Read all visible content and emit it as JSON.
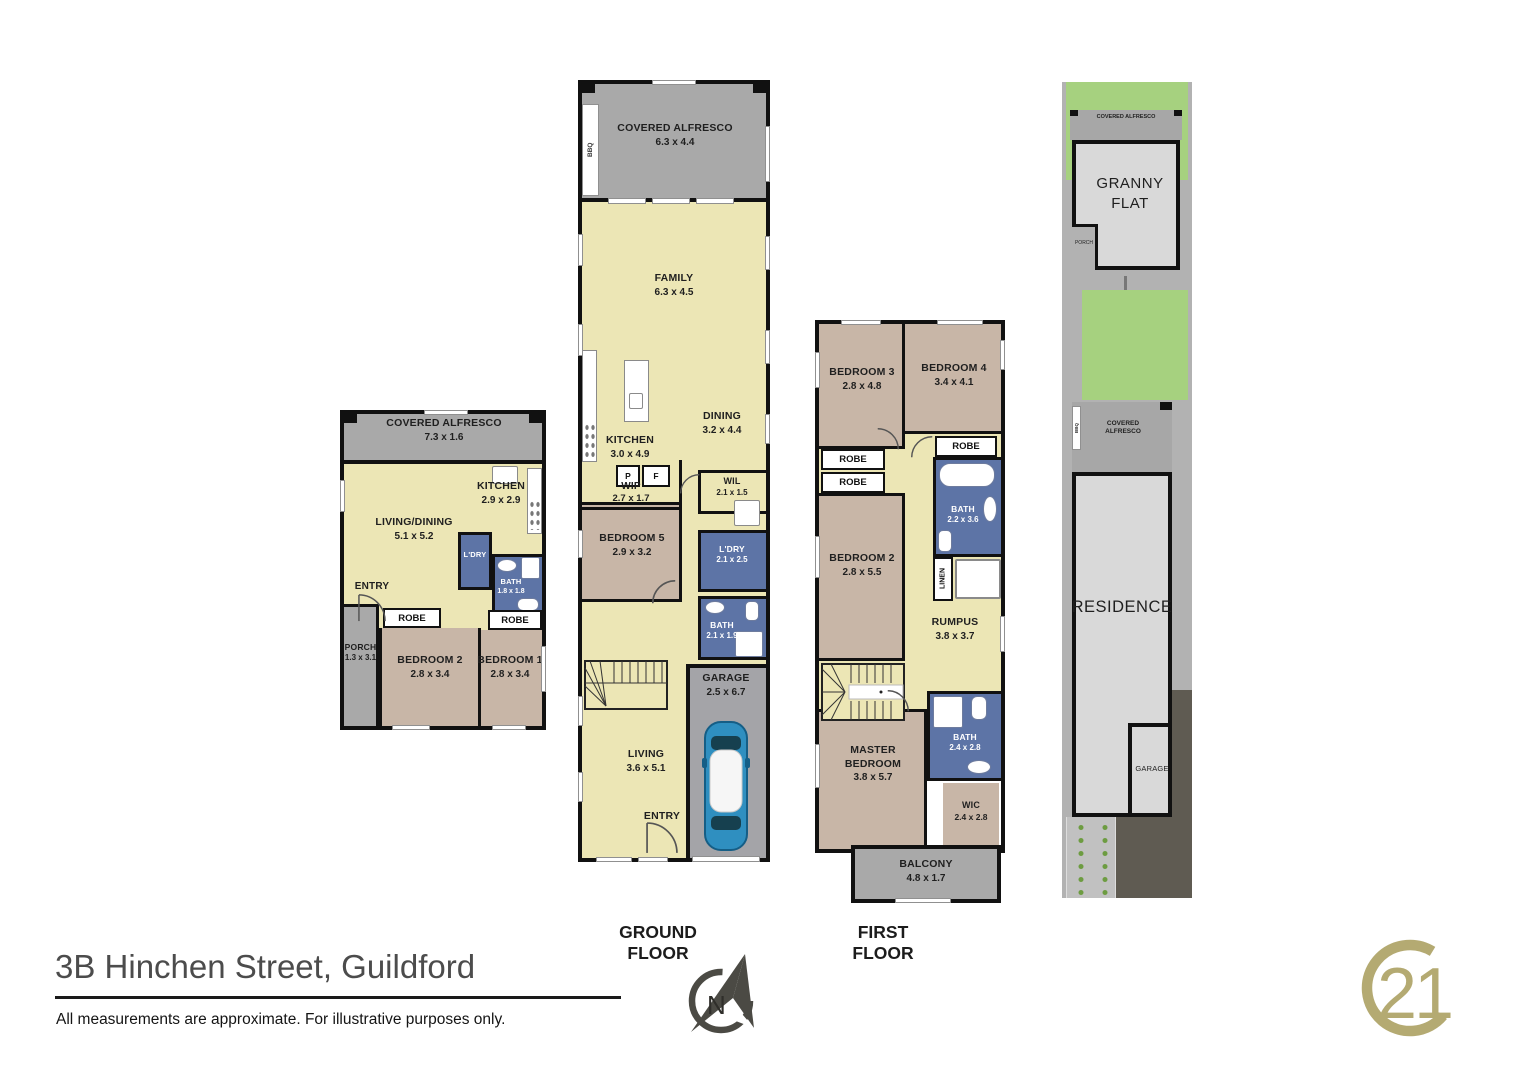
{
  "footer": {
    "address": "3B Hinchen Street, Guildford",
    "disclaimer": "All measurements are approximate. For illustrative purposes only.",
    "ground_label": "GROUND FLOOR",
    "first_label": "FIRST FLOOR",
    "north": "N"
  },
  "logo": {
    "number": "21",
    "color": "#b4aa72"
  },
  "colors": {
    "living": "#ece6b5",
    "bedroom": "#c8b6a7",
    "wet": "#5d74a6",
    "alfresco": "#a9a9a9",
    "wall": "#111111",
    "garage_floor": "#a4a4a8",
    "site_green": "#a6d17f",
    "site_light": "#d9d9d9",
    "site_mid": "#b2b2b2",
    "site_dark": "#5f5b52"
  },
  "gf": {
    "alfresco": {
      "n": "COVERED ALFRESCO",
      "d": "7.3 x 1.6"
    },
    "kitchen": {
      "n": "KITCHEN",
      "d": "2.9 x 2.9"
    },
    "living": {
      "n": "LIVING/DINING",
      "d": "5.1 x 5.2"
    },
    "ldry": {
      "n": "L'DRY"
    },
    "bath": {
      "n": "BATH",
      "d": "1.8 x 1.8"
    },
    "entry": {
      "n": "ENTRY"
    },
    "porch": {
      "n": "PORCH",
      "d": "1.3 x 3.1"
    },
    "robe1": {
      "n": "ROBE"
    },
    "robe2": {
      "n": "ROBE"
    },
    "bed2": {
      "n": "BEDROOM 2",
      "d": "2.8 x 3.4"
    },
    "bed1": {
      "n": "BEDROOM 1",
      "d": "2.8 x 3.4"
    }
  },
  "g": {
    "bbq": {
      "n": "BBQ"
    },
    "alfresco": {
      "n": "COVERED ALFRESCO",
      "d": "6.3 x 4.4"
    },
    "family": {
      "n": "FAMILY",
      "d": "6.3 x 4.5"
    },
    "dining": {
      "n": "DINING",
      "d": "3.2 x 4.4"
    },
    "kitchen": {
      "n": "KITCHEN",
      "d": "3.0 x 4.9"
    },
    "p": {
      "n": "P"
    },
    "fbox": {
      "n": "F"
    },
    "wip": {
      "n": "WIP",
      "d": "2.7 x 1.7"
    },
    "wil": {
      "n": "WIL",
      "d": "2.1 x 1.5"
    },
    "ldry": {
      "n": "L'DRY",
      "d": "2.1 x 2.5"
    },
    "bed5": {
      "n": "BEDROOM 5",
      "d": "2.9 x 3.2"
    },
    "bath": {
      "n": "BATH",
      "d": "2.1 x 1.9"
    },
    "garage": {
      "n": "GARAGE",
      "d": "2.5 x 6.7"
    },
    "living": {
      "n": "LIVING",
      "d": "3.6 x 5.1"
    },
    "entry": {
      "n": "ENTRY"
    }
  },
  "f": {
    "bed3": {
      "n": "BEDROOM 3",
      "d": "2.8 x 4.8"
    },
    "bed4": {
      "n": "BEDROOM 4",
      "d": "3.4 x 4.1"
    },
    "robe1": {
      "n": "ROBE"
    },
    "robe2": {
      "n": "ROBE"
    },
    "robe3": {
      "n": "ROBE"
    },
    "bath1": {
      "n": "BATH",
      "d": "2.2 x 3.6"
    },
    "linen": {
      "n": "LINEN"
    },
    "bed2": {
      "n": "BEDROOM 2",
      "d": "2.8 x 5.5"
    },
    "rumpus": {
      "n": "RUMPUS",
      "d": "3.8 x 3.7"
    },
    "bath2": {
      "n": "BATH",
      "d": "2.4 x 2.8"
    },
    "master": {
      "n": "MASTER BEDROOM",
      "d": "3.8 x 5.7"
    },
    "wic": {
      "n": "WIC",
      "d": "2.4 x 2.8"
    },
    "balcony": {
      "n": "BALCONY",
      "d": "4.8 x 1.7"
    }
  },
  "site": {
    "alfresco1": {
      "n": "COVERED ALFRESCO"
    },
    "granny": {
      "n": "GRANNY FLAT"
    },
    "porch": {
      "n": "PORCH"
    },
    "bbq": {
      "n": "BBQ"
    },
    "alfresco2": {
      "n": "COVERED ALFRESCO"
    },
    "residence": {
      "n": "RESIDENCE"
    },
    "garage": {
      "n": "GARAGE"
    }
  }
}
